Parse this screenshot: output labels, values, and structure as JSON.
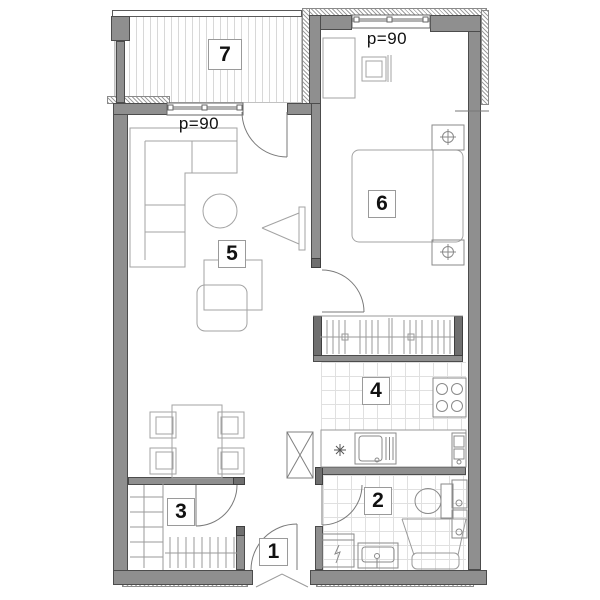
{
  "plan": {
    "room_labels": {
      "r1": "1",
      "r2": "2",
      "r3": "3",
      "r4": "4",
      "r5": "5",
      "r6": "6",
      "r7": "7"
    },
    "annotations": {
      "living_window_parapet": "p=90",
      "bedroom_window_parapet": "p=90"
    },
    "colors": {
      "wall_fill": "#8f8f8f",
      "wall_cap": "#6f6f6f",
      "wall_outline": "#4c4c4c",
      "furniture_line": "#a3a3a3",
      "door_line": "#7a7a7a",
      "sanitary_line": "#8a8a8a",
      "tile_line": "#e0e0e0",
      "balcony_stripe": "#d8d8d8",
      "label_text": "#111111"
    }
  }
}
